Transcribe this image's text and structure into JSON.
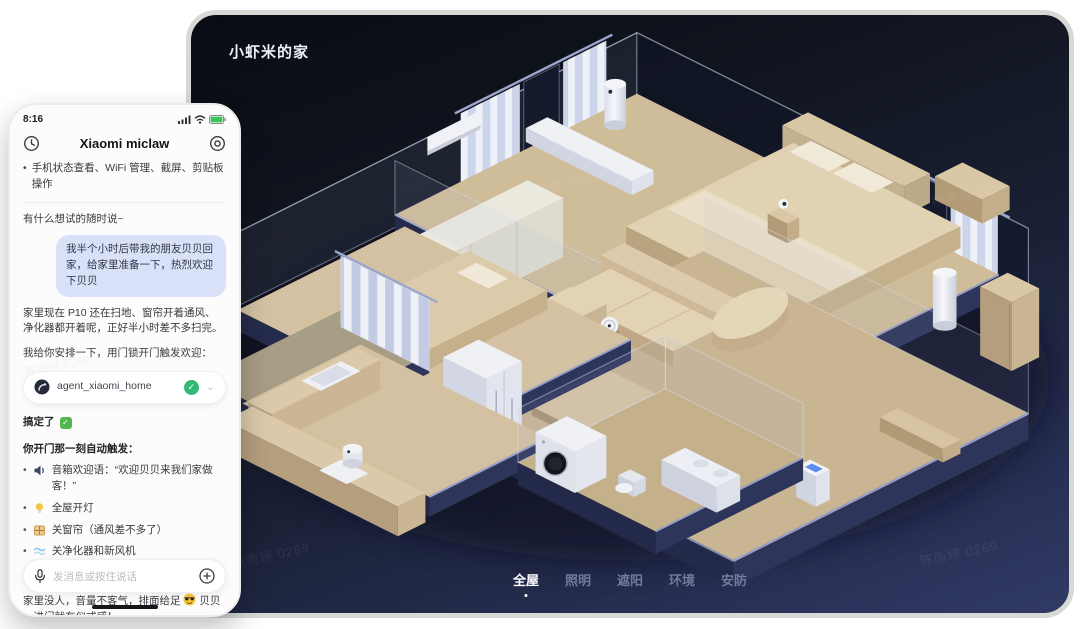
{
  "panel": {
    "title": "小虾米的家",
    "watermark": "陈雨婷 0269",
    "nav": {
      "tabs": [
        {
          "label": "全屋",
          "active": true
        },
        {
          "label": "照明",
          "active": false
        },
        {
          "label": "遮阳",
          "active": false
        },
        {
          "label": "环境",
          "active": false
        },
        {
          "label": "安防",
          "active": false
        }
      ]
    }
  },
  "scene": {
    "devices": [
      "air-conditioner",
      "curtains",
      "air-purifier",
      "robot-vacuum",
      "washing-machine",
      "fridge",
      "rice-cooker",
      "camera",
      "bed",
      "sofa",
      "coffee-table",
      "dining-table",
      "kitchen-counter",
      "wardrobe",
      "cabinet"
    ],
    "palette": {
      "panel_bg": "#1a2136",
      "floor": "#cfbc99",
      "plinth_dark": "#2e355a",
      "plinth_light": "#98a1c5",
      "wall_edge": "#d7e0f5",
      "device_white": "#f1f2f6",
      "accent_blue": "#5a8dee"
    }
  },
  "phone": {
    "status": {
      "time": "8:16"
    },
    "header": {
      "title": "Xiaomi miclaw"
    },
    "capabilities": "手机状态查看、WiFi 管理、截屏、剪贴板操作",
    "hint": "有什么想试的随时说~",
    "user_message": "我半个小时后带我的朋友贝贝回家，给家里准备一下，热烈欢迎下贝贝",
    "reply_1": "家里现在 P10 还在扫地、窗帘开着通风、净化器都开着呢，正好半小时差不多扫完。",
    "reply_2": "我给你安排一下，用门锁开门触发欢迎：",
    "agent_card": {
      "name": "agent_xiaomi_home",
      "status_icon": "check-circle-icon"
    },
    "done_text": "搞定了",
    "trigger_title": "你开门那一刻自动触发：",
    "triggers": [
      {
        "icon": "speaker-icon",
        "text": "音箱欢迎语：“欢迎贝贝来我们家做客！”"
      },
      {
        "icon": "bulb-icon",
        "text": "全屋开灯"
      },
      {
        "icon": "window-icon",
        "text": "关窗帘（通风差不多了）"
      },
      {
        "icon": "wind-icon",
        "text": "关净化器和新风机"
      },
      {
        "icon": "music-icon",
        "text": "放欢快音乐"
      }
    ],
    "closing_prefix": "家里没人，音量不客气，排面给足",
    "closing_suffix": "贝贝一进门就有仪式感！",
    "input": {
      "placeholder": "发消息或按住说话"
    }
  }
}
